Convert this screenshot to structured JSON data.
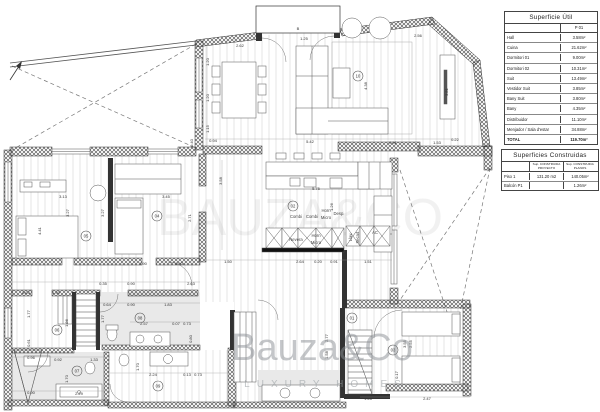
{
  "tables": {
    "superficie_util": {
      "title": "Superficie Útil",
      "col": "P 01",
      "rows": [
        {
          "label": "Hall",
          "value": "3.58m²"
        },
        {
          "label": "Cuina",
          "value": "21.62m²"
        },
        {
          "label": "Dormitori 01",
          "value": "9.00m²"
        },
        {
          "label": "Dormitori 02",
          "value": "10.31m²"
        },
        {
          "label": "Suit",
          "value": "13.49m²"
        },
        {
          "label": "Vestidor Suit",
          "value": "3.85m²"
        },
        {
          "label": "Bany Suit",
          "value": "3.80m²"
        },
        {
          "label": "Bany",
          "value": "4.35m²"
        },
        {
          "label": "Distribuidor",
          "value": "11.10m²"
        },
        {
          "label": "Menjador / Sala d'estar",
          "value": "34.88m²"
        },
        {
          "label": "TOTAL",
          "value": "119.70m²"
        }
      ]
    },
    "superficies_construidas": {
      "title": "Superficies Construidas",
      "cols": [
        "Sup. CONSTRUIDA PROYECTO",
        "Sup. CONSTRUIDA PLANOS"
      ],
      "rows": [
        {
          "label": "Piso 1",
          "proyecto": "131.20 m2",
          "planos": "140.05m²"
        },
        {
          "label": "Balcón P1",
          "proyecto": "",
          "planos": "1.26m²"
        }
      ]
    }
  },
  "watermark": {
    "brand": "Bauza&Co",
    "tagline": "LUXURY HOMES",
    "ghost": "BAUZA&CO"
  },
  "plan": {
    "room_markers": [
      {
        "n": "10",
        "x": 358,
        "y": 76
      },
      {
        "n": "02",
        "x": 293,
        "y": 206
      },
      {
        "n": "05",
        "x": 86,
        "y": 236
      },
      {
        "n": "04",
        "x": 157,
        "y": 216
      },
      {
        "n": "06",
        "x": 57,
        "y": 330
      },
      {
        "n": "08",
        "x": 140,
        "y": 318
      },
      {
        "n": "07",
        "x": 77,
        "y": 371
      },
      {
        "n": "09",
        "x": 158,
        "y": 386
      },
      {
        "n": "03",
        "x": 393,
        "y": 350
      },
      {
        "n": "01",
        "x": 352,
        "y": 318
      }
    ],
    "appliance_labels": [
      {
        "t": "Combi",
        "x": 296,
        "y": 218
      },
      {
        "t": "Combi",
        "x": 312,
        "y": 218
      },
      {
        "t": "Horn",
        "x": 326,
        "y": 212
      },
      {
        "t": "Micro",
        "x": 326,
        "y": 219
      },
      {
        "t": "Desp.",
        "x": 339,
        "y": 215
      },
      {
        "t": "Nevera",
        "x": 296,
        "y": 241
      },
      {
        "t": "Horn",
        "x": 316,
        "y": 237
      },
      {
        "t": "Micro",
        "x": 316,
        "y": 244
      },
      {
        "t": "Llav.",
        "x": 352,
        "y": 237,
        "r": -90
      },
      {
        "t": "Secad.",
        "x": 359,
        "y": 237,
        "r": -90
      },
      {
        "t": "AC",
        "x": 375,
        "y": 234
      }
    ],
    "dimensions": [
      {
        "t": "2.62",
        "x": 240,
        "y": 47
      },
      {
        "t": "B",
        "x": 298,
        "y": 30
      },
      {
        "t": "1.25",
        "x": 304,
        "y": 40
      },
      {
        "t": "2.56",
        "x": 418,
        "y": 37
      },
      {
        "t": "1.20",
        "x": 209,
        "y": 62,
        "r": -90
      },
      {
        "t": "1.20",
        "x": 209,
        "y": 98,
        "r": -90
      },
      {
        "t": "1.15",
        "x": 209,
        "y": 129,
        "r": -90
      },
      {
        "t": "0.40",
        "x": 193,
        "y": 143,
        "r": -90
      },
      {
        "t": "0.94",
        "x": 213,
        "y": 142
      },
      {
        "t": "5.42",
        "x": 310,
        "y": 143
      },
      {
        "t": "0.91",
        "x": 393,
        "y": 144
      },
      {
        "t": "1.53",
        "x": 437,
        "y": 144
      },
      {
        "t": "0.22",
        "x": 455,
        "y": 141
      },
      {
        "t": "4.38",
        "x": 367,
        "y": 86,
        "r": -90
      },
      {
        "t": "3.81",
        "x": 448,
        "y": 92,
        "r": -90
      },
      {
        "t": "3.58",
        "x": 222,
        "y": 181,
        "r": -90
      },
      {
        "t": "5.75",
        "x": 316,
        "y": 190
      },
      {
        "t": "1.26",
        "x": 333,
        "y": 207,
        "r": -90
      },
      {
        "t": "3.13",
        "x": 63,
        "y": 198
      },
      {
        "t": "3.45",
        "x": 166,
        "y": 198
      },
      {
        "t": "3.27",
        "x": 69,
        "y": 213,
        "r": -90
      },
      {
        "t": "3.27",
        "x": 104,
        "y": 213,
        "r": -90
      },
      {
        "t": "4.41",
        "x": 41,
        "y": 231,
        "r": -90
      },
      {
        "t": "2.71",
        "x": 191,
        "y": 218,
        "r": -90
      },
      {
        "t": "1.90",
        "x": 143,
        "y": 265
      },
      {
        "t": "0.90",
        "x": 179,
        "y": 265
      },
      {
        "t": "1.50",
        "x": 228,
        "y": 263
      },
      {
        "t": "2.64",
        "x": 300,
        "y": 263
      },
      {
        "t": "0.20",
        "x": 318,
        "y": 263
      },
      {
        "t": "0.91",
        "x": 334,
        "y": 263
      },
      {
        "t": "1.51",
        "x": 368,
        "y": 263
      },
      {
        "t": "0.63",
        "x": 26,
        "y": 294
      },
      {
        "t": "1.30",
        "x": 56,
        "y": 294
      },
      {
        "t": "0.35",
        "x": 103,
        "y": 285
      },
      {
        "t": "0.90",
        "x": 131,
        "y": 285
      },
      {
        "t": "2.63",
        "x": 191,
        "y": 285
      },
      {
        "t": "1.77",
        "x": 30,
        "y": 314,
        "r": -90
      },
      {
        "t": "1.86",
        "x": 68,
        "y": 323,
        "r": -90
      },
      {
        "t": "0.61",
        "x": 30,
        "y": 343,
        "r": -90
      },
      {
        "t": "0.64",
        "x": 107,
        "y": 306
      },
      {
        "t": "0.90",
        "x": 131,
        "y": 306
      },
      {
        "t": "1.83",
        "x": 168,
        "y": 306
      },
      {
        "t": "1.77",
        "x": 104,
        "y": 319,
        "r": -90
      },
      {
        "t": "2.57",
        "x": 144,
        "y": 325
      },
      {
        "t": "0.07",
        "x": 176,
        "y": 325
      },
      {
        "t": "0.73",
        "x": 187,
        "y": 325
      },
      {
        "t": "0.80",
        "x": 192,
        "y": 339,
        "r": -90
      },
      {
        "t": "0.96",
        "x": 31,
        "y": 359
      },
      {
        "t": "0.92",
        "x": 58,
        "y": 361
      },
      {
        "t": "1.33",
        "x": 94,
        "y": 361
      },
      {
        "t": "1.70",
        "x": 68,
        "y": 379,
        "r": -90
      },
      {
        "t": "0.90",
        "x": 31,
        "y": 394
      },
      {
        "t": "2.29",
        "x": 79,
        "y": 395
      },
      {
        "t": "1.70",
        "x": 139,
        "y": 367,
        "r": -90
      },
      {
        "t": "2.24",
        "x": 153,
        "y": 376
      },
      {
        "t": "0.13",
        "x": 187,
        "y": 376
      },
      {
        "t": "0.73",
        "x": 198,
        "y": 376
      },
      {
        "t": "2.77",
        "x": 328,
        "y": 338,
        "r": -90
      },
      {
        "t": "1.58",
        "x": 328,
        "y": 355,
        "r": -90
      },
      {
        "t": "3.55",
        "x": 406,
        "y": 344,
        "r": -90
      },
      {
        "t": "2.55",
        "x": 412,
        "y": 344,
        "r": -90
      },
      {
        "t": "0.17",
        "x": 398,
        "y": 375,
        "r": -90
      },
      {
        "t": "1.28",
        "x": 368,
        "y": 400
      },
      {
        "t": "2.47",
        "x": 427,
        "y": 400
      }
    ]
  }
}
